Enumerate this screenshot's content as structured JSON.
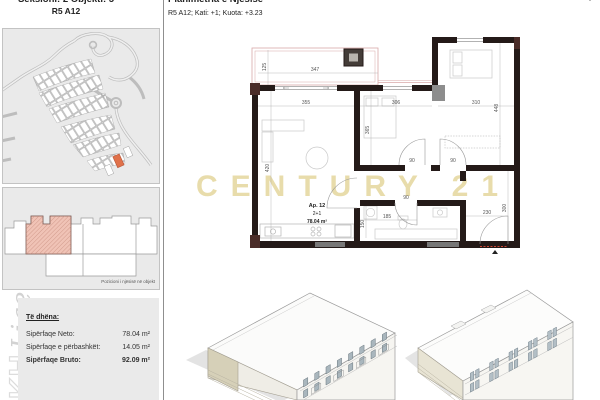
{
  "sidebar": {
    "header_line1": "Seksioni: 2  Objekti: 5",
    "header_line2": "R5 A12",
    "elevation_caption": "Pozicioni i njësisë në objekt",
    "data_panel": {
      "title": "Të dhëna:",
      "rows": [
        {
          "label": "Sipërfaqe Neto:",
          "value": "78.04 m²"
        },
        {
          "label": "Sipërfaqe e përbashkët:",
          "value": "14.05 m²"
        },
        {
          "label": "Sipërfaqe Bruto:",
          "value": "92.09 m²"
        }
      ]
    },
    "brand_watermark": {
      "outline_text": "KH",
      "script_text": "Liqeni"
    }
  },
  "header": {
    "title": "Planimetria e Njësisë",
    "subtitle": "R5 A12; Kati: +1; Kuota: +3.23"
  },
  "watermark": {
    "text": "CENTURY 21",
    "color": "#e8dcab"
  },
  "plan": {
    "unit": {
      "name": "Ap. 12",
      "rooms": "2+1",
      "area": "78.04 m²"
    },
    "dims": {
      "balcony_w": "347",
      "balcony_h": "125",
      "living_w": "355",
      "living_h": "420",
      "bedroom1_w": "306",
      "bedroom1_h": "365",
      "bedroom2_w": "310",
      "bedroom2_h": "448",
      "bath_w": "185",
      "bath_h": "150",
      "entry_w": "230",
      "entry_h": "300",
      "door_a": "90",
      "door_b": "90",
      "door_c": "90"
    }
  },
  "colors": {
    "wall": "#241a18",
    "highlight_plot": "#e0714a",
    "unit_fill": "#f0c3b6",
    "balcony_line": "#d8a8a8",
    "entry_line": "#cc4433",
    "panel_bg": "#eaeaea"
  }
}
